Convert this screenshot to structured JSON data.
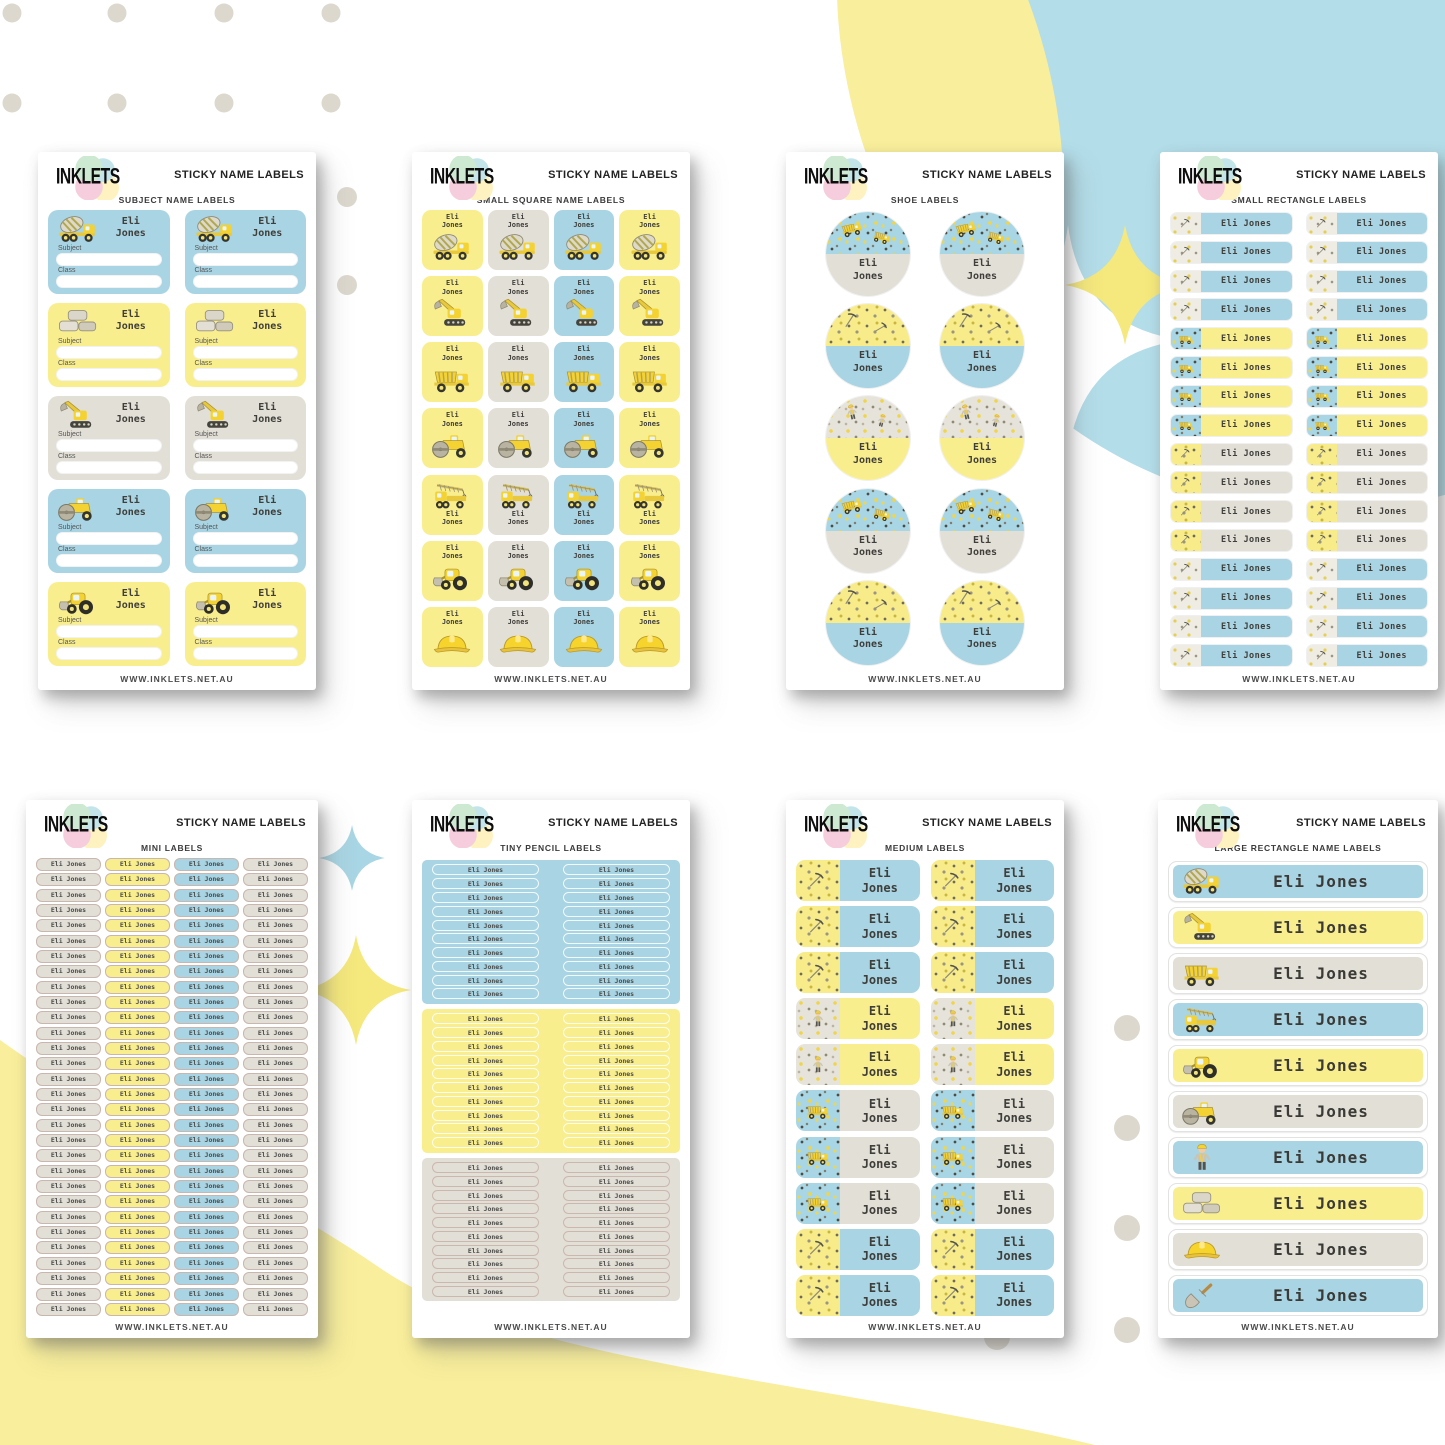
{
  "page": {
    "brand": "INKLETS",
    "title": "STICKY NAME LABELS",
    "footer": "WWW.INKLETS.NET.AU",
    "name_full": "Eli Jones",
    "name_first": "Eli",
    "name_last": "Jones"
  },
  "colors": {
    "blue": "#a8d4e3",
    "yellow": "#f9ee8e",
    "gray": "#e2dfd6",
    "mini_border": "#c9b6ae",
    "name_text": "#3f3e3a",
    "bg_blue_blob": "#b3dde9",
    "bg_yellow_blob": "#f8ee9b",
    "bg_dot": "#dcd8ce",
    "sparkle_yellow": "#f5e87c",
    "sparkle_blue": "#a9d6e4"
  },
  "sheets": [
    {
      "subtitle": "SUBJECT NAME LABELS",
      "type": "subject",
      "columns": 2,
      "field_labels": [
        "Subject",
        "Class"
      ],
      "rows": [
        {
          "color": "blue",
          "icon": "cement-mixer-icon"
        },
        {
          "color": "yellow",
          "icon": "bricks-icon"
        },
        {
          "color": "gray",
          "icon": "excavator-icon"
        },
        {
          "color": "blue",
          "icon": "road-roller-icon"
        },
        {
          "color": "yellow",
          "icon": "front-loader-icon"
        }
      ]
    },
    {
      "subtitle": "SMALL SQUARE NAME LABELS",
      "type": "squares",
      "column_colors": [
        "yellow",
        "gray",
        "blue",
        "yellow"
      ],
      "rows": [
        {
          "icon": "cement-mixer-icon",
          "name_position": "top"
        },
        {
          "icon": "excavator-icon",
          "name_position": "top"
        },
        {
          "icon": "dump-truck-icon",
          "name_position": "top"
        },
        {
          "icon": "road-roller-icon",
          "name_position": "top"
        },
        {
          "icon": "crane-truck-icon",
          "name_position": "bottom"
        },
        {
          "icon": "front-loader-icon",
          "name_position": "top"
        },
        {
          "icon": "hard-hat-icon",
          "name_position": "top"
        }
      ]
    },
    {
      "subtitle": "SHOE LABELS",
      "type": "circles",
      "columns": 2,
      "rows": [
        {
          "top_pattern": "blue",
          "bottom_color": "gray"
        },
        {
          "top_pattern": "yellow",
          "bottom_color": "blue"
        },
        {
          "top_pattern": "gray",
          "bottom_color": "yellow"
        },
        {
          "top_pattern": "blue",
          "bottom_color": "gray"
        },
        {
          "top_pattern": "yellow",
          "bottom_color": "blue"
        }
      ]
    },
    {
      "subtitle": "SMALL RECTANGLE LABELS",
      "type": "small-rects",
      "columns": 2,
      "groups": [
        {
          "rows": 4,
          "pattern": "light",
          "body": "blue"
        },
        {
          "rows": 4,
          "pattern": "blue",
          "body": "yellow"
        },
        {
          "rows": 4,
          "pattern": "yellow",
          "body": "gray"
        },
        {
          "rows": 4,
          "pattern": "light",
          "body": "blue"
        }
      ]
    },
    {
      "subtitle": "MINI LABELS",
      "type": "mini",
      "rows": 30,
      "column_colors": [
        "gray",
        "yellow",
        "blue",
        "gray"
      ]
    },
    {
      "subtitle": "TINY PENCIL LABELS",
      "type": "pencil",
      "columns": 2,
      "blocks": [
        {
          "color": "blue",
          "rows": 10
        },
        {
          "color": "yellow",
          "rows": 10
        },
        {
          "color": "gray",
          "rows": 10
        }
      ]
    },
    {
      "subtitle": "MEDIUM LABELS",
      "type": "medium",
      "columns": 2,
      "rows": [
        {
          "pattern": "yellow",
          "body": "blue"
        },
        {
          "pattern": "yellow",
          "body": "blue"
        },
        {
          "pattern": "yellow",
          "body": "blue"
        },
        {
          "pattern": "gray",
          "body": "yellow"
        },
        {
          "pattern": "gray",
          "body": "yellow"
        },
        {
          "pattern": "blue",
          "body": "gray"
        },
        {
          "pattern": "blue",
          "body": "gray"
        },
        {
          "pattern": "blue",
          "body": "gray"
        },
        {
          "pattern": "yellow",
          "body": "blue"
        },
        {
          "pattern": "yellow",
          "body": "blue"
        }
      ]
    },
    {
      "subtitle": "LARGE RECTANGLE NAME LABELS",
      "type": "large-rects",
      "rows": [
        {
          "color": "blue",
          "icon": "cement-mixer-icon"
        },
        {
          "color": "yellow",
          "icon": "excavator-icon"
        },
        {
          "color": "gray",
          "icon": "dump-truck-icon"
        },
        {
          "color": "blue",
          "icon": "crane-truck-icon"
        },
        {
          "color": "yellow",
          "icon": "front-loader-icon"
        },
        {
          "color": "gray",
          "icon": "road-roller-icon"
        },
        {
          "color": "blue",
          "icon": "worker-icon"
        },
        {
          "color": "yellow",
          "icon": "bricks-icon"
        },
        {
          "color": "gray",
          "icon": "hard-hat-icon"
        },
        {
          "color": "blue",
          "icon": "trowel-icon"
        }
      ]
    }
  ]
}
